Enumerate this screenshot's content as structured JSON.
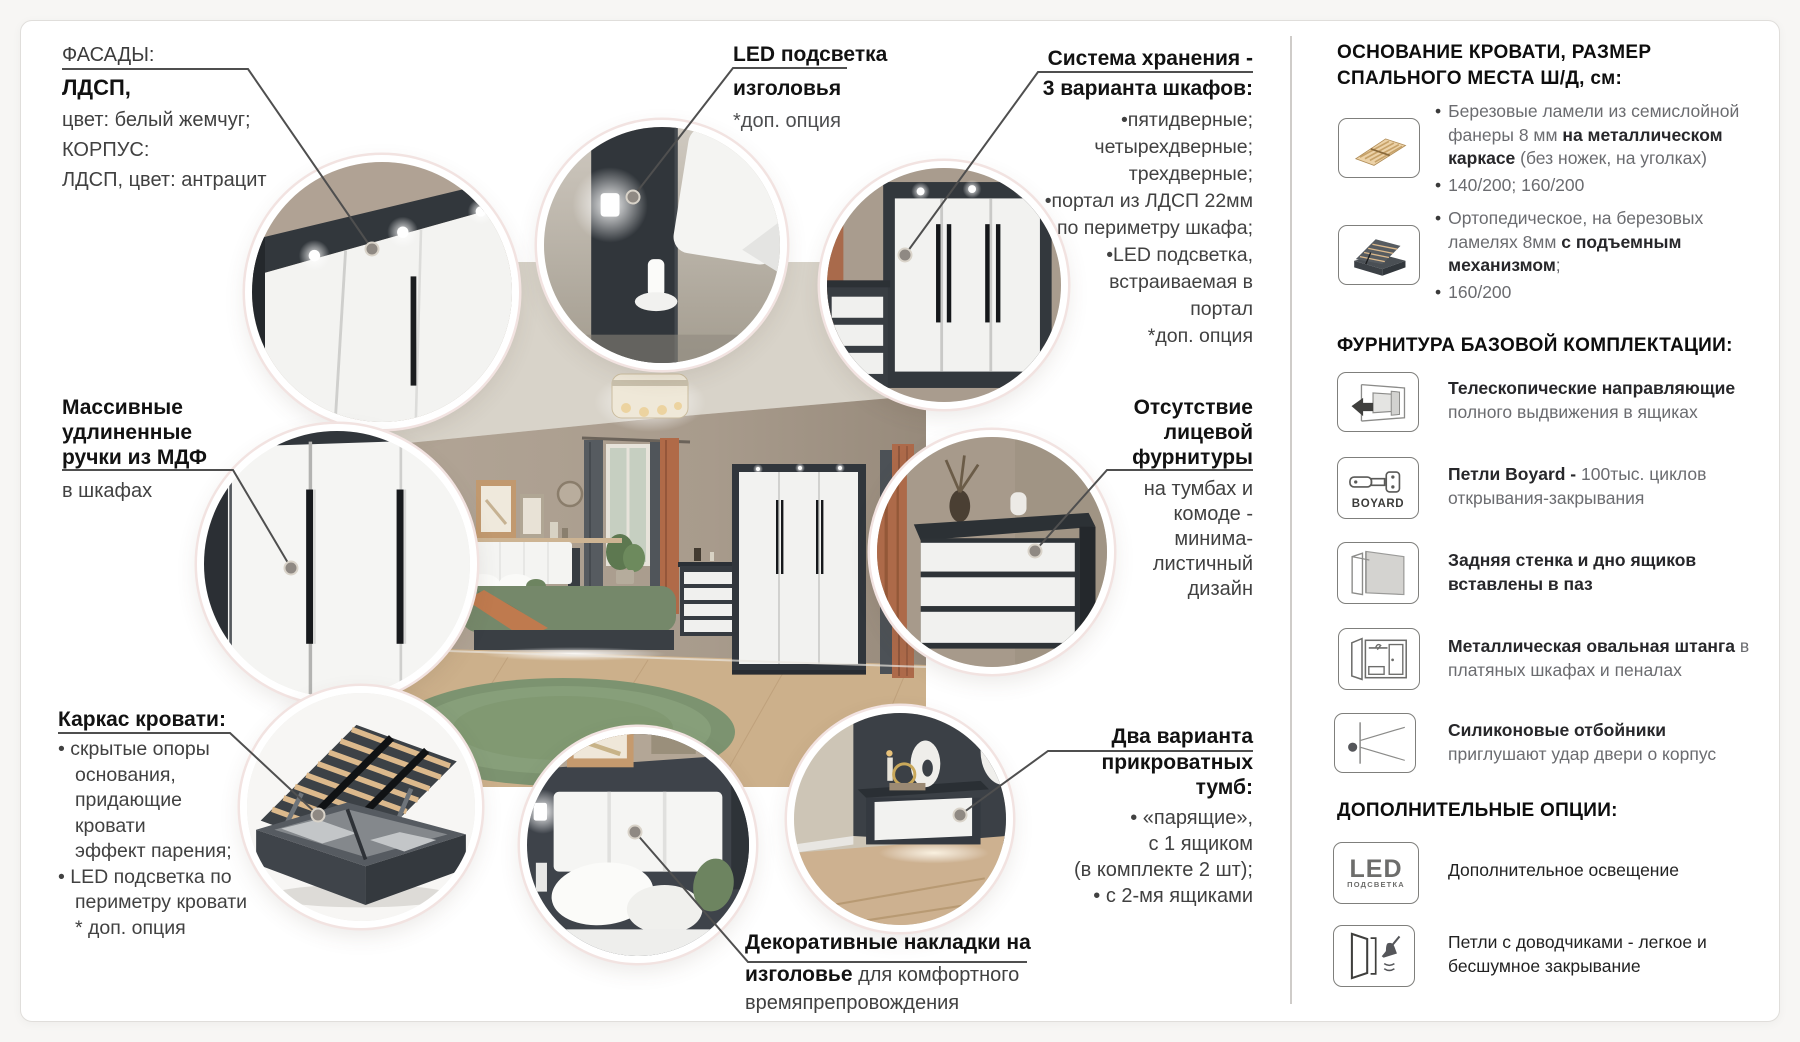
{
  "palette": {
    "anthracite": "#33383d",
    "pearl_white": "#f2f2f0",
    "wall": "#a89b8c",
    "floor": "#ccb08b",
    "rug_green": "#7c9370",
    "orange": "#b06a48",
    "line": "#4f4f4f",
    "ring": "#f2e3e1"
  },
  "callouts": {
    "facades": {
      "label": "ФАСАДЫ:",
      "bold": "ЛДСП,",
      "l1": "цвет: белый жемчуг;",
      "l2": "КОРПУС:",
      "l3": "ЛДСП, цвет: антрацит"
    },
    "led": {
      "t1": "LED подсветка",
      "t2": "изголовья",
      "note": "*доп. опция"
    },
    "storage": {
      "t1": "Система хранения -",
      "t2": "3 варианта шкафов:",
      "lines": [
        "•пятидверные;",
        "четырехдверные;",
        "трехдверные;",
        "•портал из ЛДСП 22мм",
        "по периметру шкафа;",
        "•LED подсветка,",
        "встраиваемая в",
        "портал",
        "*доп. опция"
      ]
    },
    "handles": {
      "l1": "Массивные",
      "l2": "удлиненные",
      "l3": "ручки из МДФ",
      "tail": "в шкафах"
    },
    "nofittings": {
      "l1": "Отсутствие",
      "l2": "лицевой",
      "l3": "фурнитуры",
      "lines": [
        "на тумбах и",
        "комоде -",
        "минима-",
        "листичный",
        "дизайн"
      ]
    },
    "bedframe": {
      "title": "Каркас кровати:",
      "lines": [
        "• скрытые опоры",
        "основания,",
        "придающие",
        "кровати",
        "эффект парения;",
        "• LED подсветка по",
        "периметру кровати",
        "* доп. опция"
      ]
    },
    "decor": {
      "b1": "Декоративные накладки на",
      "b2": "изголовье",
      "r1": " для комфортного",
      "r2": "времяпрепровождения"
    },
    "nightstands": {
      "l1": "Два варианта",
      "l2": "прикроватных",
      "l3": "тумб:",
      "lines": [
        "• «парящие»,",
        "с 1 ящиком",
        "(в комплекте 2 шт);",
        "• с 2-мя ящиками"
      ]
    }
  },
  "sidebar": {
    "bullet": "•",
    "h1": "ОСНОВАНИЕ КРОВАТИ, РАЗМЕР СПАЛЬНОГО МЕСТА Ш/Д, см:",
    "base": [
      {
        "t1": "Березовые ламели из семислойной фанеры 8 мм ",
        "b": "на металлическом каркасе",
        "t2": " (без ножек, на уголках)",
        "size": "140/200; 160/200"
      },
      {
        "t1": "Ортопедическое, на березовых ламелях 8мм ",
        "b": "с подъемным механизмом",
        "t2": ";",
        "size": "160/200"
      }
    ],
    "h2": "ФУРНИТУРА БАЗОВОЙ КОМПЛЕКТАЦИИ:",
    "boyard_label": "BOYARD",
    "fittings": [
      {
        "b": "Телескопические направляющие",
        "t": " полного выдвижения в ящиках"
      },
      {
        "b": "Петли Boyard - ",
        "t": "100тыс. циклов открывания-закрывания"
      },
      {
        "b": "Задняя стенка и дно ящиков вставлены в паз",
        "t": ""
      },
      {
        "b": "Металлическая овальная штанга",
        "t": " в платяных шкафах и пеналах"
      },
      {
        "b": "Силиконовые отбойники",
        "t": "приглушают удар двери о корпус"
      }
    ],
    "h3": "ДОПОЛНИТЕЛЬНЫЕ ОПЦИИ:",
    "led_big": "LED",
    "led_small": "ПОДСВЕТКА",
    "options": [
      {
        "t": "Дополнительное освещение"
      },
      {
        "t": "Петли с доводчиками - легкое и бесшумное закрывание"
      }
    ]
  }
}
